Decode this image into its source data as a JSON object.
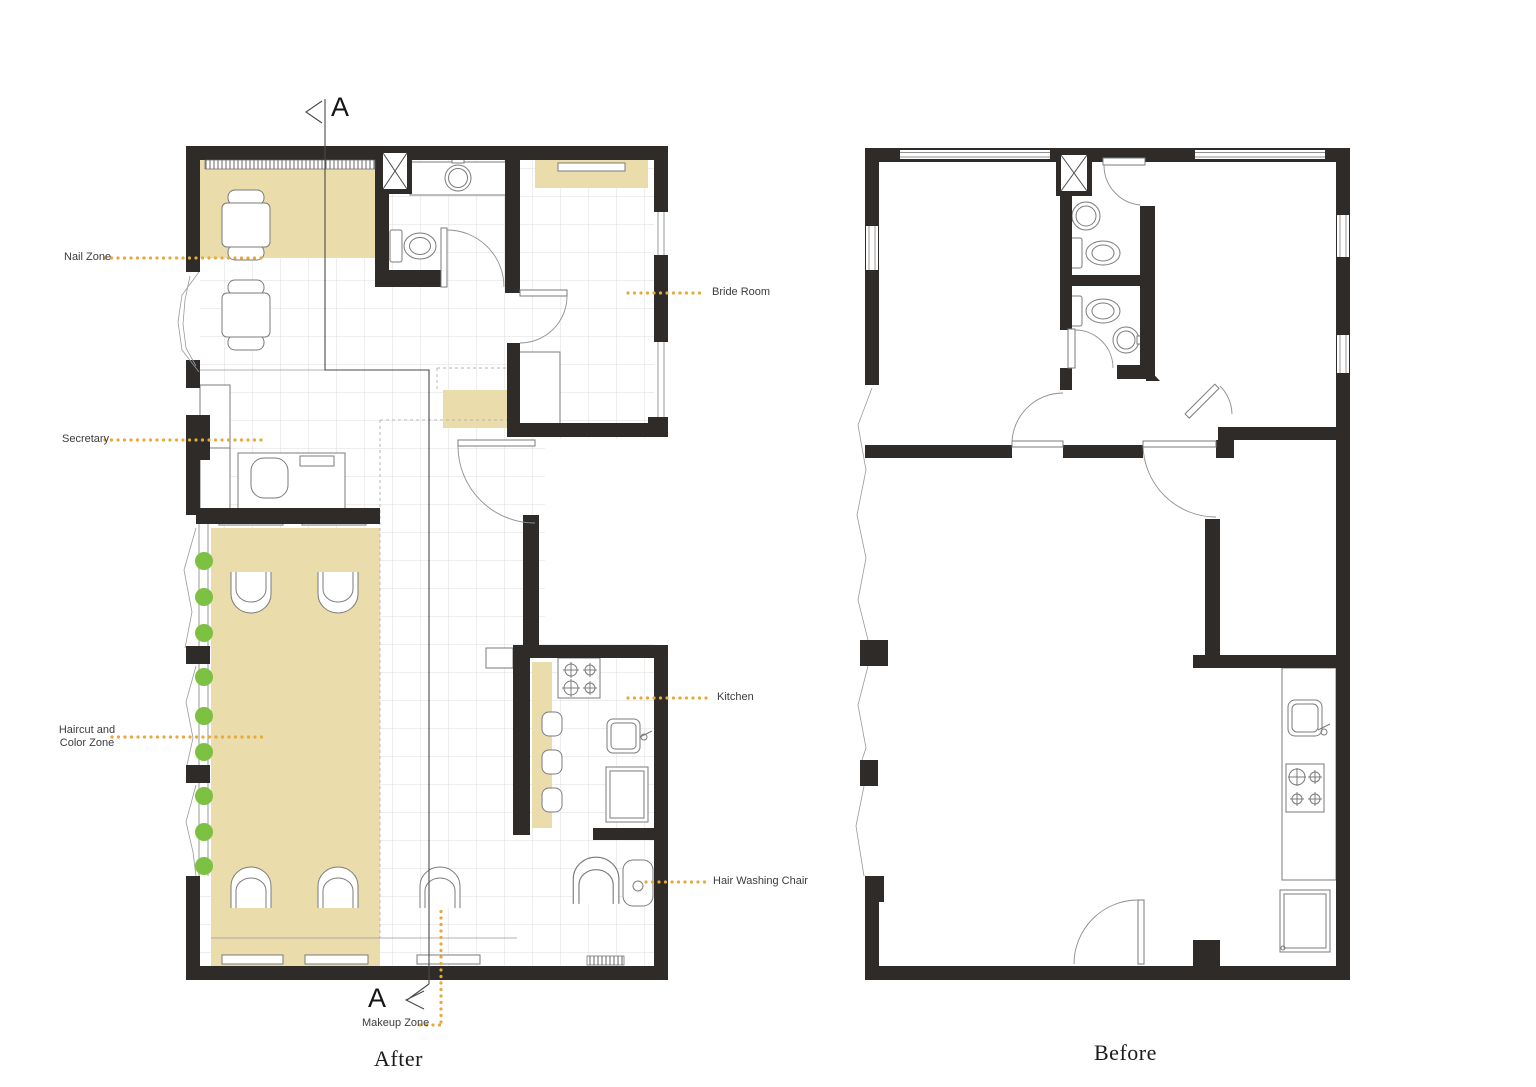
{
  "titles": {
    "after": "After",
    "before": "Before"
  },
  "section_marker": "A",
  "labels": {
    "nail_zone": "Nail Zone",
    "secretary": "Secretary",
    "haircut_color_zone": "Haircut and\nColor Zone",
    "makeup_zone": "Makeup Zone",
    "bride_room": "Bride Room",
    "kitchen": "Kitchen",
    "hair_washing_chair": "Hair Washing Chair"
  },
  "colors": {
    "wall": "#2E2B28",
    "zone_tan": "#EBDCAC",
    "leader_orange": "#E8A93B",
    "plant_green": "#7CC142",
    "label_ink": "#3C3C3C",
    "grid_gray": "#DCDCDC"
  }
}
